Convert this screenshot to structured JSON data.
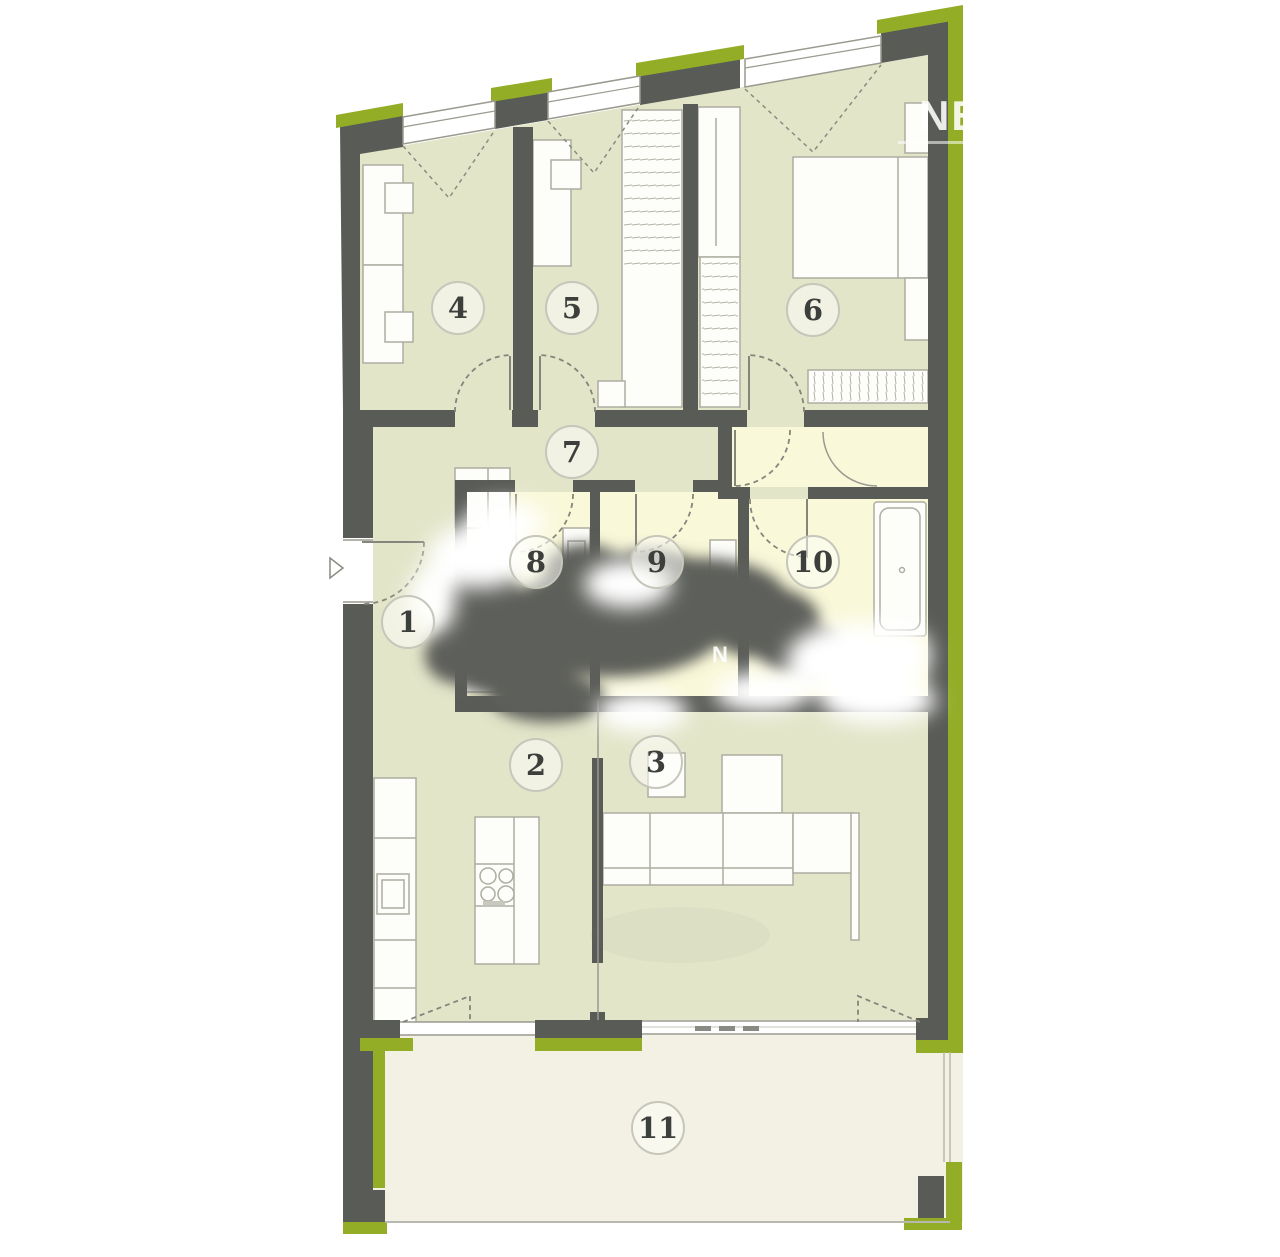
{
  "meta": {
    "type": "apartment-floor-plan"
  },
  "watermark": {
    "text": "NE",
    "mini_mark": "N"
  },
  "colors": {
    "wall": "#595b57",
    "accent_green": "#94ad27",
    "room_fill": "#e3e5c9",
    "wet_room_fill": "#f9f8d9",
    "terrace_fill": "#f2f1e3",
    "furniture_fill": "#fdfdfa",
    "furniture_stroke": "#adada1"
  },
  "rooms": [
    {
      "id": "1",
      "label": "1",
      "cx": 408,
      "cy": 622
    },
    {
      "id": "2",
      "label": "2",
      "cx": 536,
      "cy": 765
    },
    {
      "id": "3",
      "label": "3",
      "cx": 656,
      "cy": 762
    },
    {
      "id": "4",
      "label": "4",
      "cx": 458,
      "cy": 308
    },
    {
      "id": "5",
      "label": "5",
      "cx": 572,
      "cy": 308
    },
    {
      "id": "6",
      "label": "6",
      "cx": 813,
      "cy": 310
    },
    {
      "id": "7",
      "label": "7",
      "cx": 572,
      "cy": 452
    },
    {
      "id": "8",
      "label": "8",
      "cx": 536,
      "cy": 562
    },
    {
      "id": "9",
      "label": "9",
      "cx": 657,
      "cy": 562
    },
    {
      "id": "10",
      "label": "10",
      "cx": 813,
      "cy": 562
    },
    {
      "id": "11",
      "label": "11",
      "cx": 658,
      "cy": 1128
    }
  ]
}
